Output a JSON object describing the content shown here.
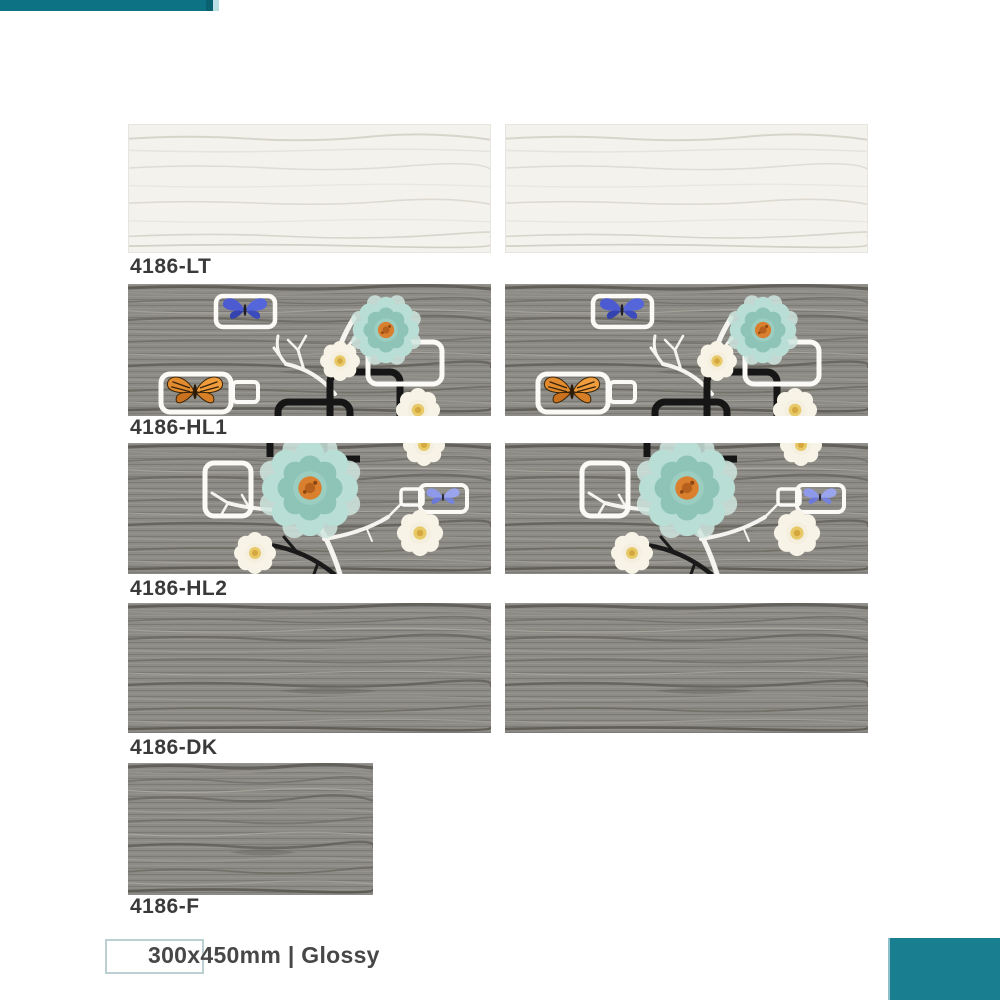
{
  "accent": {
    "teal": "#0d7384",
    "teal_corner": "#1a7e91"
  },
  "products": [
    {
      "code": "4186-LT",
      "variant": "light",
      "tiles_shown": 2
    },
    {
      "code": "4186-HL1",
      "variant": "highlighter-1",
      "tiles_shown": 2
    },
    {
      "code": "4186-HL2",
      "variant": "highlighter-2",
      "tiles_shown": 2
    },
    {
      "code": "4186-DK",
      "variant": "dark",
      "tiles_shown": 2
    },
    {
      "code": "4186-F",
      "variant": "floor",
      "tiles_shown": 1
    }
  ],
  "footer": {
    "size_text": "300x450mm | Glossy"
  },
  "icons": [
    "blue-butterfly-icon",
    "orange-butterfly-icon",
    "periwinkle-butterfly-icon",
    "teal-flower-icon",
    "cream-flower-icon",
    "white-branch-icon",
    "black-frame-icon",
    "white-frame-icon"
  ]
}
